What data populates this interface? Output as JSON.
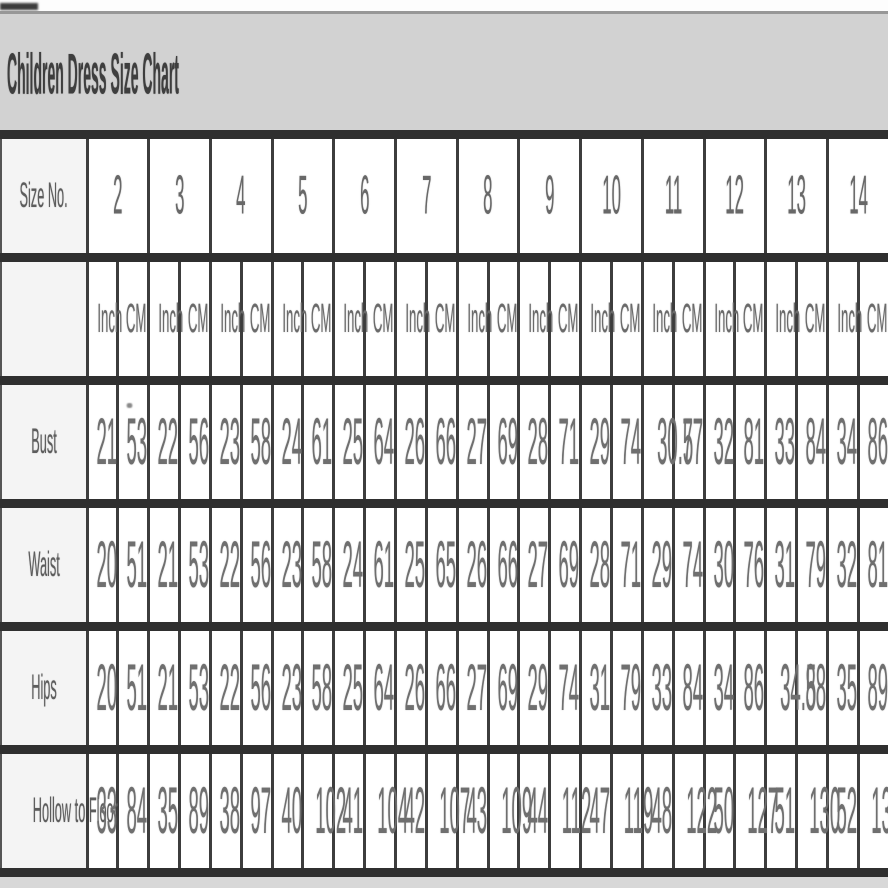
{
  "title": "Children Dress Size Chart",
  "table": {
    "corner_label": "Size No.",
    "sizes": [
      "2",
      "3",
      "4",
      "5",
      "6",
      "7",
      "8",
      "9",
      "10",
      "11",
      "12",
      "13",
      "14"
    ],
    "unit_labels": [
      "Inch",
      "CM"
    ],
    "rows": [
      {
        "label": "Bust",
        "values": [
          [
            "21",
            "53"
          ],
          [
            "22",
            "56"
          ],
          [
            "23",
            "58"
          ],
          [
            "24",
            "61"
          ],
          [
            "25",
            "64"
          ],
          [
            "26",
            "66"
          ],
          [
            "27",
            "69"
          ],
          [
            "28",
            "71"
          ],
          [
            "29",
            "74"
          ],
          [
            "30.5",
            "77"
          ],
          [
            "32",
            "81"
          ],
          [
            "33",
            "84"
          ],
          [
            "34",
            "86"
          ]
        ]
      },
      {
        "label": "Waist",
        "values": [
          [
            "20",
            "51"
          ],
          [
            "21",
            "53"
          ],
          [
            "22",
            "56"
          ],
          [
            "23",
            "58"
          ],
          [
            "24",
            "61"
          ],
          [
            "25",
            "65"
          ],
          [
            "26",
            "66"
          ],
          [
            "27",
            "69"
          ],
          [
            "28",
            "71"
          ],
          [
            "29",
            "74"
          ],
          [
            "30",
            "76"
          ],
          [
            "31",
            "79"
          ],
          [
            "32",
            "81"
          ]
        ]
      },
      {
        "label": "Hips",
        "values": [
          [
            "20",
            "51"
          ],
          [
            "21",
            "53"
          ],
          [
            "22",
            "56"
          ],
          [
            "23",
            "58"
          ],
          [
            "25",
            "64"
          ],
          [
            "26",
            "66"
          ],
          [
            "27",
            "69"
          ],
          [
            "29",
            "74"
          ],
          [
            "31",
            "79"
          ],
          [
            "33",
            "84"
          ],
          [
            "34",
            "86"
          ],
          [
            "34.5",
            "88"
          ],
          [
            "35",
            "89"
          ]
        ]
      },
      {
        "label": "Hollow to Floor",
        "values": [
          [
            "33",
            "84"
          ],
          [
            "35",
            "89"
          ],
          [
            "38",
            "97"
          ],
          [
            "40",
            "102"
          ],
          [
            "41",
            "104"
          ],
          [
            "42",
            "107"
          ],
          [
            "43",
            "109"
          ],
          [
            "44",
            "112"
          ],
          [
            "47",
            "119"
          ],
          [
            "48",
            "122"
          ],
          [
            "50",
            "127"
          ],
          [
            "51",
            "130"
          ],
          [
            "52",
            "132"
          ]
        ]
      }
    ]
  },
  "colors": {
    "title_band_bg": "#d2d2d2",
    "title_text": "#3e3e3e",
    "border_dark": "#2f2f2f",
    "label_cell_bg": "#f4f4f4",
    "cell_bg": "#ffffff",
    "value_text": "#6f6f6f"
  }
}
